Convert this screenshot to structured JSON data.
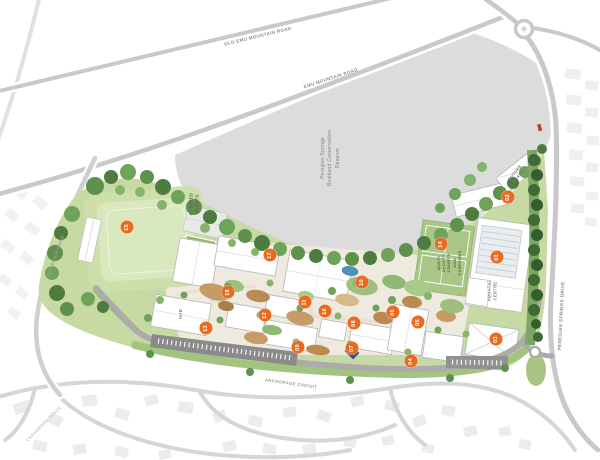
{
  "colors": {
    "marker_bg": "#EA6A1F",
    "reserve_gray": "#DCDCDC",
    "road_gray": "#C9C9C9",
    "field_green": "#CDE0AB",
    "tree_green": "#4D7C3E",
    "water_blue": "#4E93B8"
  },
  "roads": {
    "old_emu": "OLD EMU MOUNTAIN ROAD",
    "emu": "EMU MOUNTAIN ROAD",
    "peregian_springs": "PEREGIAN SPRINGS DRIVE",
    "ridgeview": "RIDGEVIEW DRIVE",
    "anchorage": "ANCHORAGE CIRCUIT",
    "cresbrook": "CRESBROOK PLACE"
  },
  "reserve": {
    "lines": [
      "Peregian Springs",
      "Bushland Conservation",
      "Reserve"
    ]
  },
  "facilities": {
    "covered_courts": {
      "lines": [
        "COVERED",
        "COURTS"
      ]
    },
    "multi_sports": {
      "lines": [
        "MULTI",
        "SPORTS",
        "COURTS",
        "AND",
        "CARPARKS"
      ]
    },
    "aquatic": {
      "lines": [
        "AQUATIC",
        "CENTRE"
      ]
    },
    "chapel": {
      "lines": [
        "FUTURE",
        "CHAPEL"
      ]
    },
    "hub": "HUB"
  },
  "markers": [
    {
      "num": "01",
      "x": 497,
      "y": 257
    },
    {
      "num": "02",
      "x": 508,
      "y": 197
    },
    {
      "num": "03",
      "x": 496,
      "y": 339
    },
    {
      "num": "04",
      "x": 411,
      "y": 361
    },
    {
      "num": "05",
      "x": 418,
      "y": 322
    },
    {
      "num": "06",
      "x": 393,
      "y": 312
    },
    {
      "num": "07",
      "x": 352,
      "y": 348
    },
    {
      "num": "08",
      "x": 354,
      "y": 323
    },
    {
      "num": "09",
      "x": 298,
      "y": 347
    },
    {
      "num": "10",
      "x": 362,
      "y": 282
    },
    {
      "num": "11",
      "x": 305,
      "y": 302
    },
    {
      "num": "12",
      "x": 265,
      "y": 315
    },
    {
      "num": "13",
      "x": 206,
      "y": 328
    },
    {
      "num": "14",
      "x": 441,
      "y": 244
    },
    {
      "num": "15",
      "x": 127,
      "y": 227
    },
    {
      "num": "16",
      "x": 325,
      "y": 311
    },
    {
      "num": "17",
      "x": 270,
      "y": 255
    },
    {
      "num": "18",
      "x": 228,
      "y": 292
    }
  ]
}
